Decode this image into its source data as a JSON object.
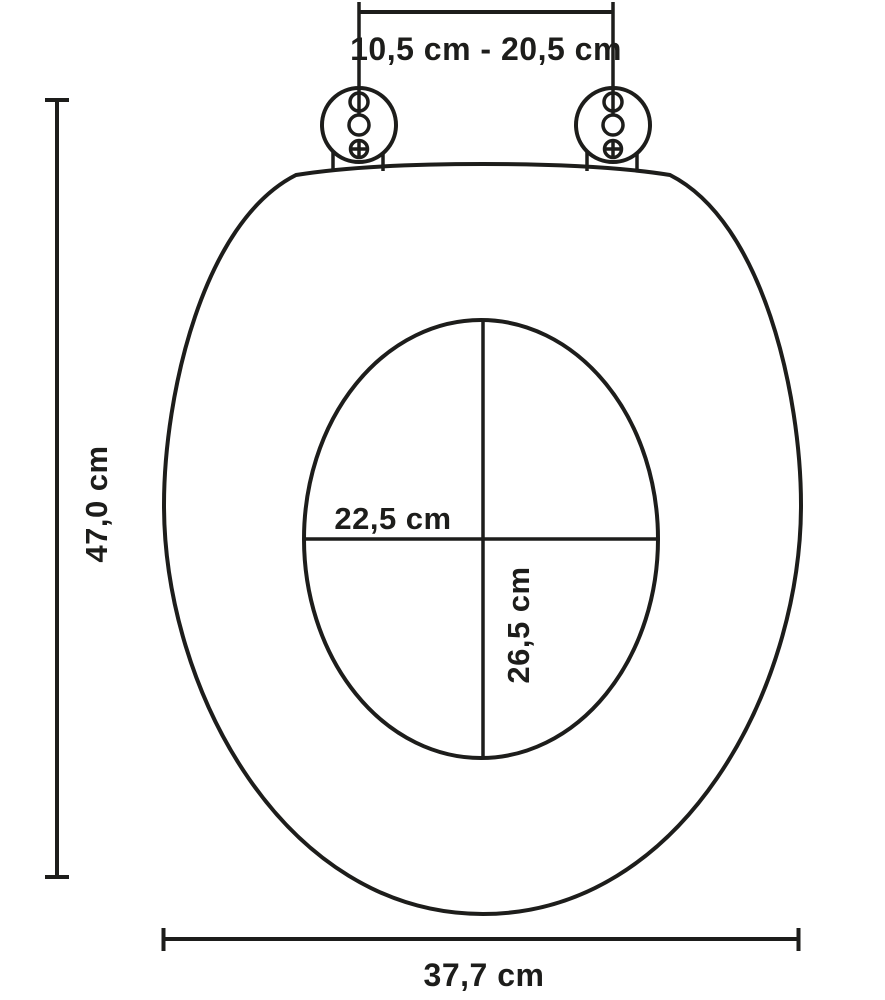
{
  "diagram": {
    "title": "toilet-seat-dimension-diagram",
    "colors": {
      "line": "#1d1d1b",
      "background": "#ffffff"
    },
    "dimensions": {
      "hinge_spacing": {
        "label": "10,5 cm - 20,5 cm"
      },
      "seat_length": {
        "label": "47,0 cm"
      },
      "inner_width": {
        "label": "22,5 cm"
      },
      "inner_length": {
        "label": "26,5 cm"
      },
      "seat_width": {
        "label": "37,7 cm"
      }
    }
  }
}
